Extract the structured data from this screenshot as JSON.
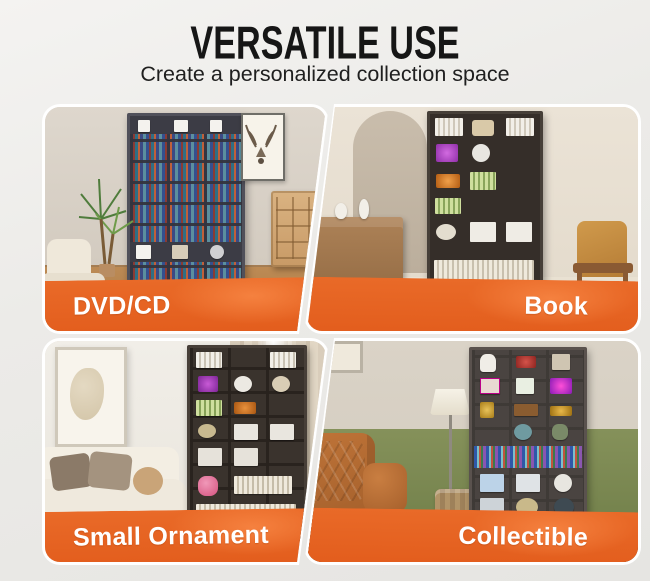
{
  "header": {
    "title": "VERSATILE USE",
    "subtitle": "Create a personalized collection space"
  },
  "panels": [
    {
      "id": "dvd-cd",
      "label": "DVD/CD"
    },
    {
      "id": "book",
      "label": "Book"
    },
    {
      "id": "small-ornament",
      "label": "Small Ornament"
    },
    {
      "id": "collectible",
      "label": "Collectible"
    }
  ],
  "colors": {
    "accent_orange": "#E96A28",
    "banner_text": "#FFFFFF",
    "title_text": "#161616",
    "background": "#ECEBE8"
  }
}
